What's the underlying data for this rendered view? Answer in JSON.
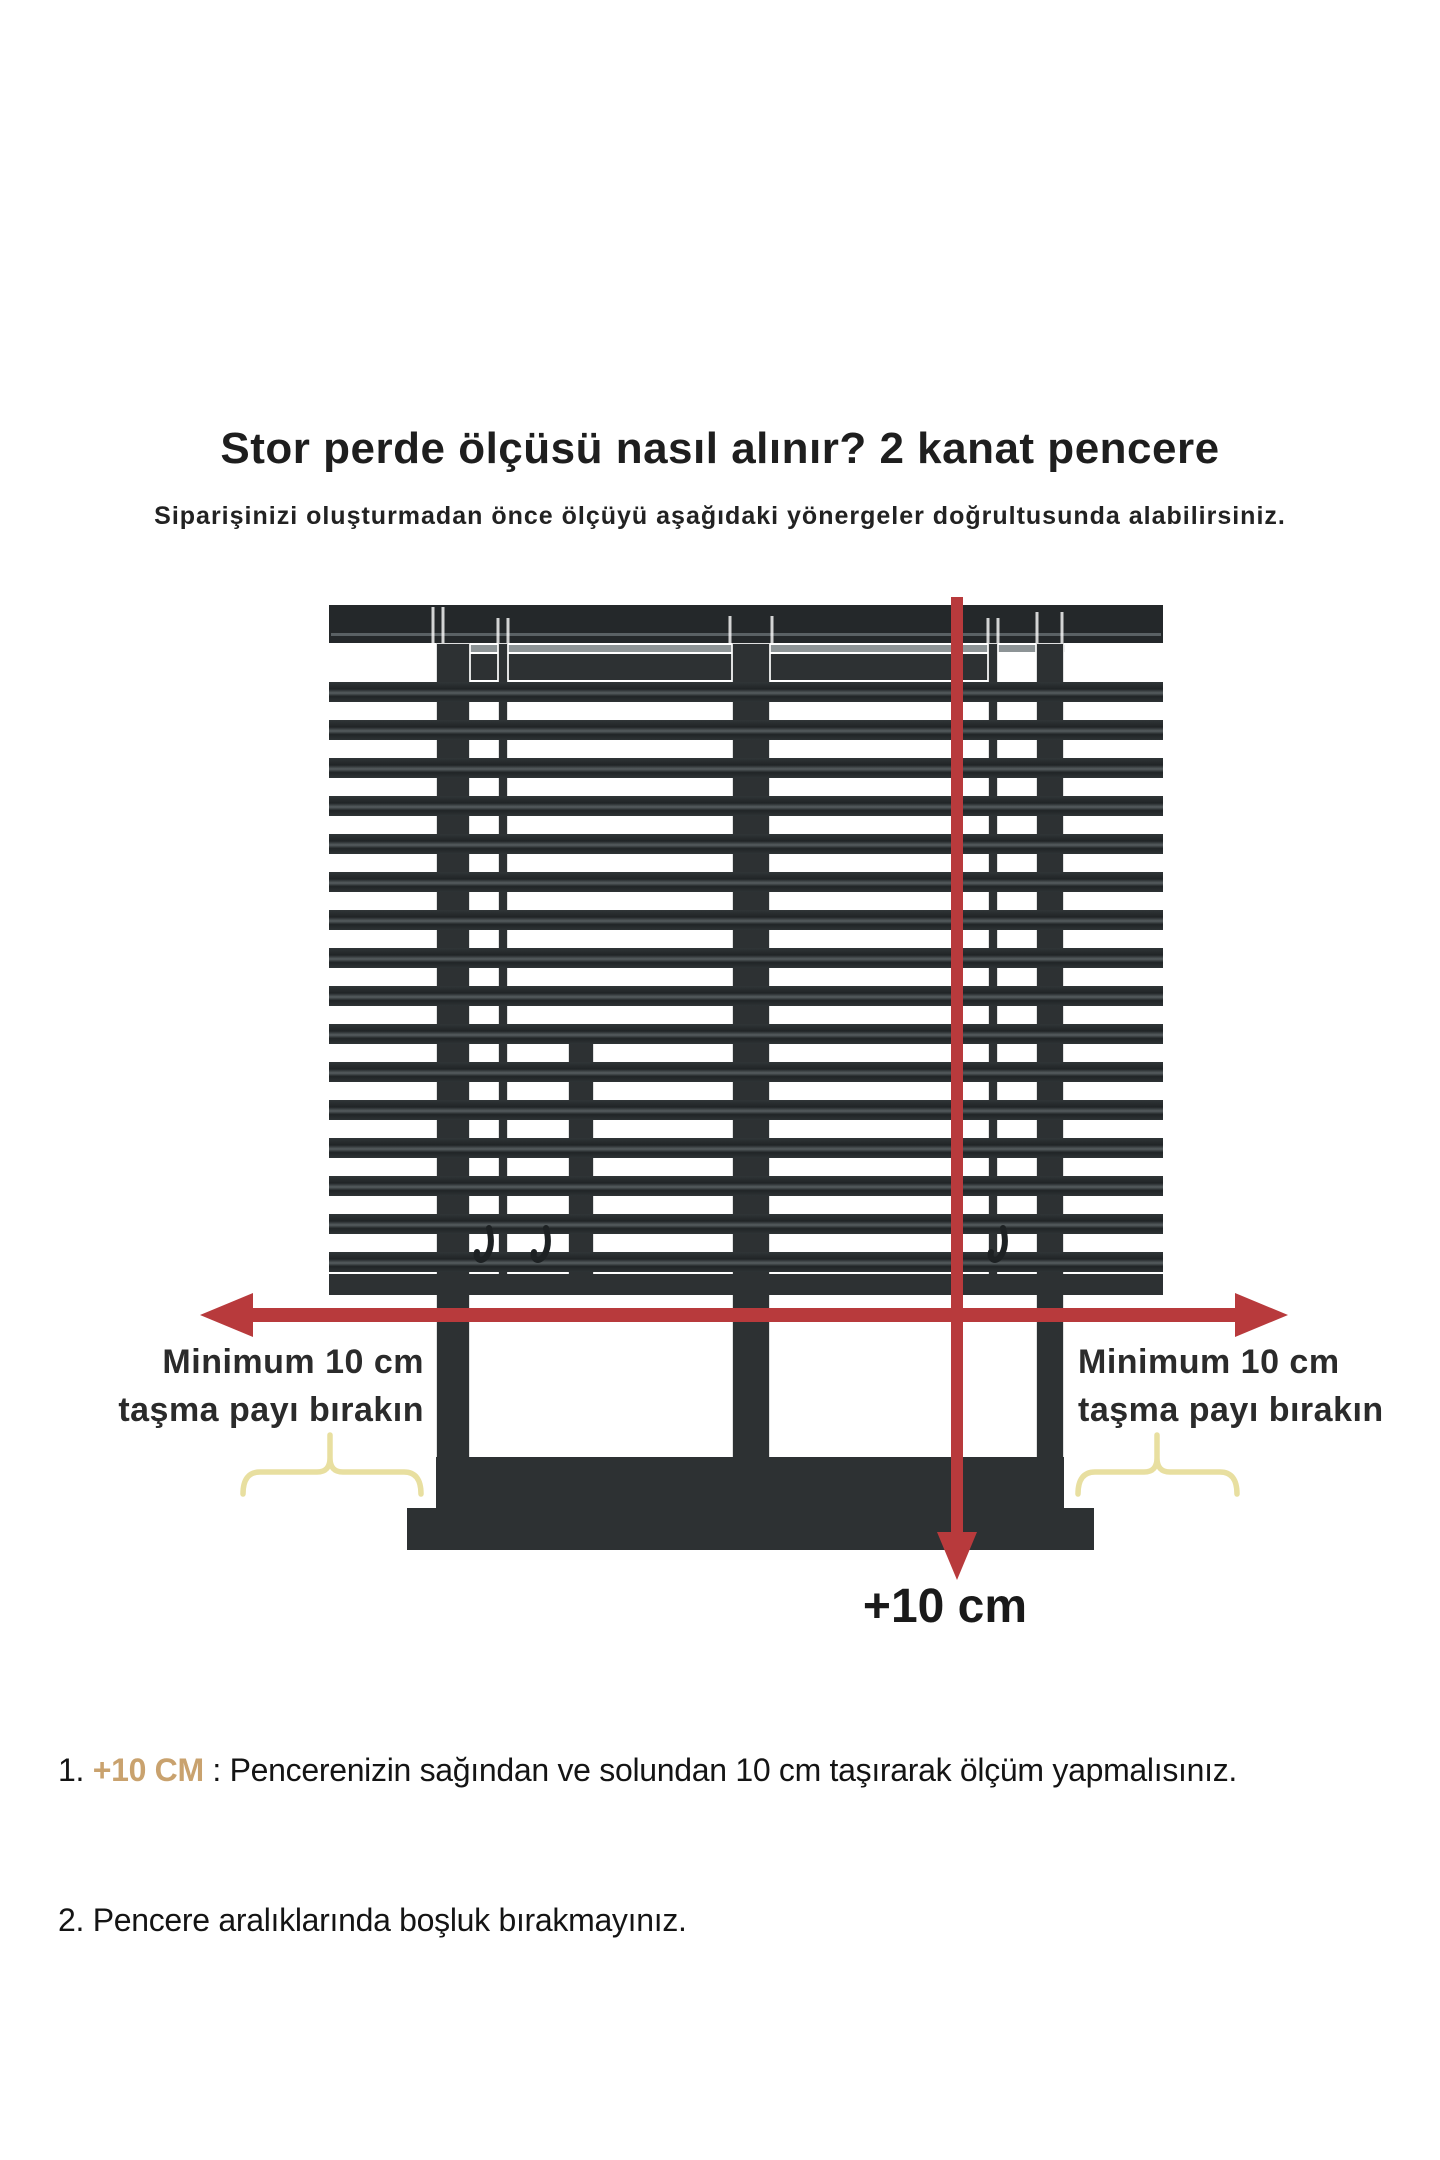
{
  "title": "Stor perde ölçüsü nasıl alınır? 2 kanat pencere",
  "subtitle": "Siparişinizi oluşturmadan önce ölçüyü aşağıdaki yönergeler doğrultusunda alabilirsiniz.",
  "diagram": {
    "description": "Two-sash window covered by venetian blind with red measurement arrows",
    "left_caption_line1": "Minimum 10 cm",
    "left_caption_line2": "taşma payı bırakın",
    "right_caption_line1": "Minimum 10 cm",
    "right_caption_line2": "taşma payı bırakın",
    "bottom_measure_label": "+10 cm"
  },
  "notes": [
    {
      "number": "1. ",
      "highlight": "+10 CM",
      "text": " : Pencerenizin sağından ve solundan 10 cm taşırarak ölçüm yapmalısınız."
    },
    {
      "number": "2. ",
      "highlight": "",
      "text": "Pencere aralıklarında boşluk bırakmayınız."
    }
  ],
  "colors": {
    "accent_red": "#b83a3c",
    "frame_dark": "#282c2e",
    "highlight_tan": "#c9a26e",
    "brace_yellow": "#e8dfa0"
  }
}
